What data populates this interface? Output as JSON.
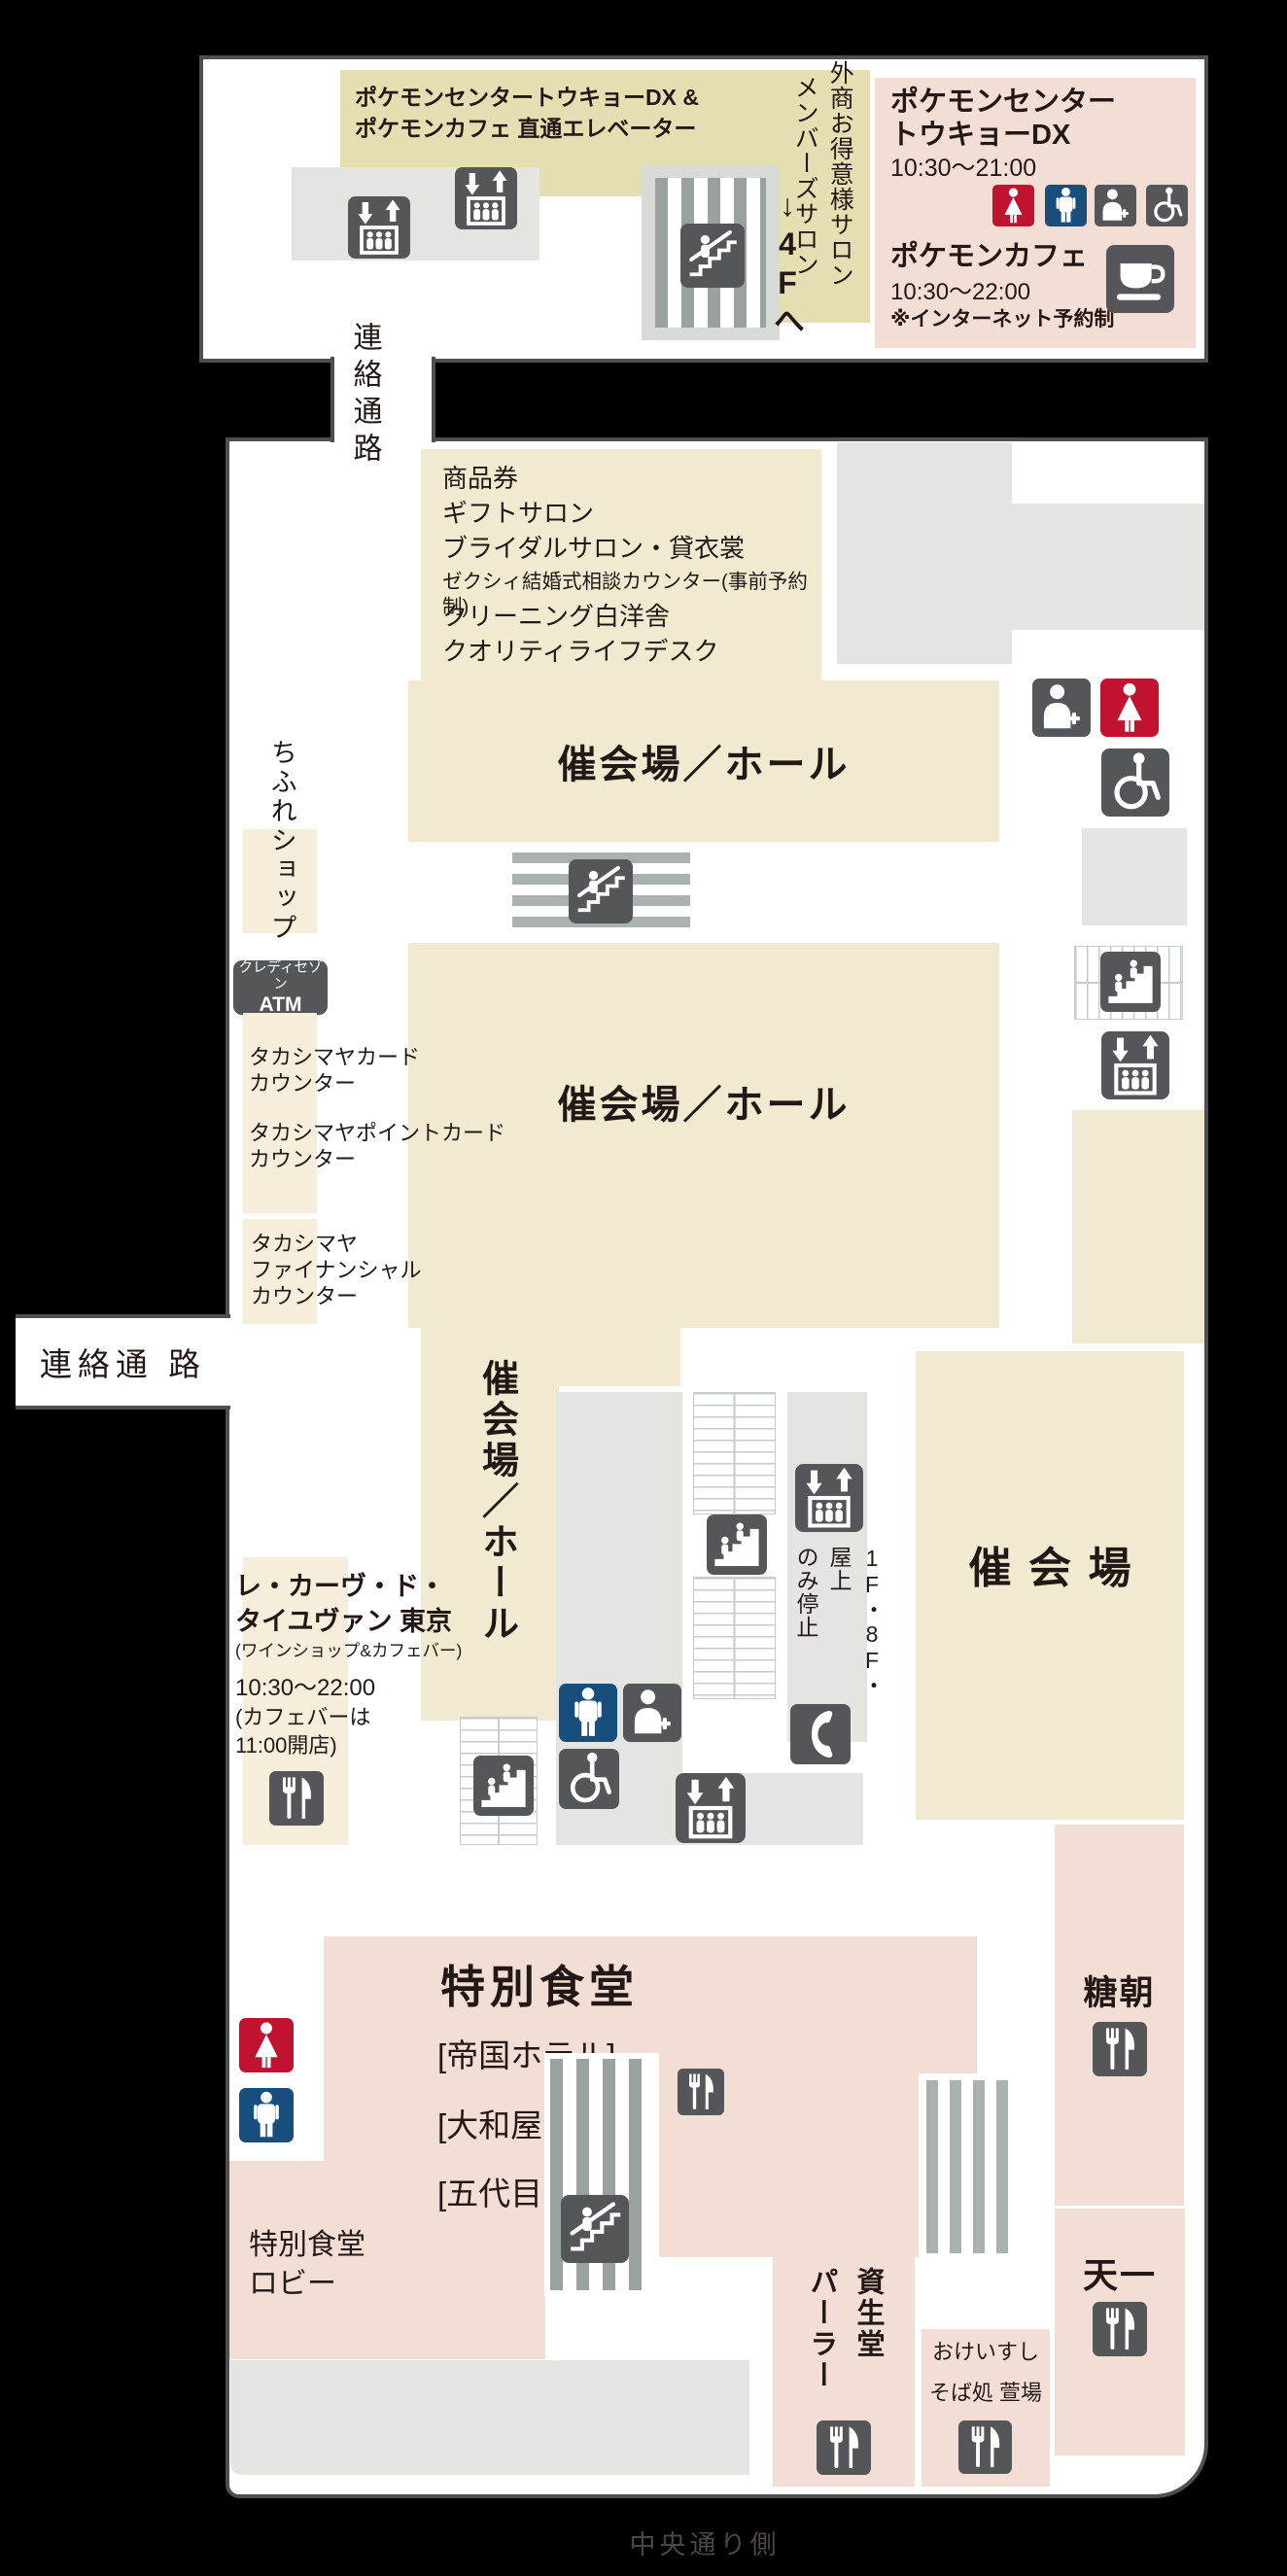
{
  "colors": {
    "tan_annex": "#e5deb3",
    "tan": "#f1e9d0",
    "tan_light": "#f5eedb",
    "pink": "#f3ded6",
    "gray": "#e4e4e0",
    "icon_bg": "#54565a",
    "red": "#c1122f",
    "navy": "#174e7b",
    "border": "#4f4f51",
    "text": "#231815"
  },
  "map": {
    "annex": {
      "direct_elevator_label": "ポケモンセンタートウキョーDX &\nポケモンカフェ 直通エレベーター",
      "salon_outer": "外商お得意様サロン",
      "salon_members": "メンバーズサロン",
      "to_4f": "↓4Fへ",
      "pokemon_center_name": "ポケモンセンター\nトウキョーDX",
      "pokemon_center_hours": "10:30～21:00",
      "pokemon_cafe_name": "ポケモンカフェ",
      "pokemon_cafe_hours": "10:30～22:00",
      "pokemon_cafe_note": "※インターネット予約制"
    },
    "corridor_vertical": "連絡通路",
    "corridor_horizontal": "連絡通 路",
    "services": [
      "商品券",
      "ギフトサロン",
      "ブライダルサロン・貸衣裳",
      "ゼクシィ結婚式相談カウンター(事前予約制)",
      "クリーニング白洋舎",
      "クオリティライフデスク"
    ],
    "halls": {
      "band1": "催会場／ホール",
      "band2": "催会場／ホール",
      "band3": "催会場／ホール",
      "right": "催会場"
    },
    "left": {
      "chifure": "ちふれショップ",
      "atm_brand": "クレディセゾン",
      "atm": "ATM",
      "card": "タカシマヤカード\nカウンター",
      "point_card": "タカシマヤポイントカード\nカウンター",
      "financial": "タカシマヤ\nファイナンシャル\nカウンター",
      "taillevent_name": "レ・カーヴ・ド・\nタイユヴァン 東京",
      "taillevent_sub": "(ワインショップ&カフェバー)",
      "taillevent_hours": "10:30～22:00",
      "taillevent_note": "(カフェバーは\n11:00開店)"
    },
    "elevator_note": "1F・8F・屋上\nのみ停止",
    "dining": {
      "title": "特別食堂",
      "restaurants": [
        "[帝国ホテル]",
        "[大和屋 三玄]",
        "[五代目 野田岩]"
      ],
      "lobby": "特別食堂\nロビー"
    },
    "restaurants": {
      "tocho": "糖朝",
      "tenichi": "天一",
      "shiseido": "資生堂\nパーラー",
      "okei": "おけいすし",
      "soba": "そば処 萱場"
    },
    "street": "中央通り側"
  }
}
